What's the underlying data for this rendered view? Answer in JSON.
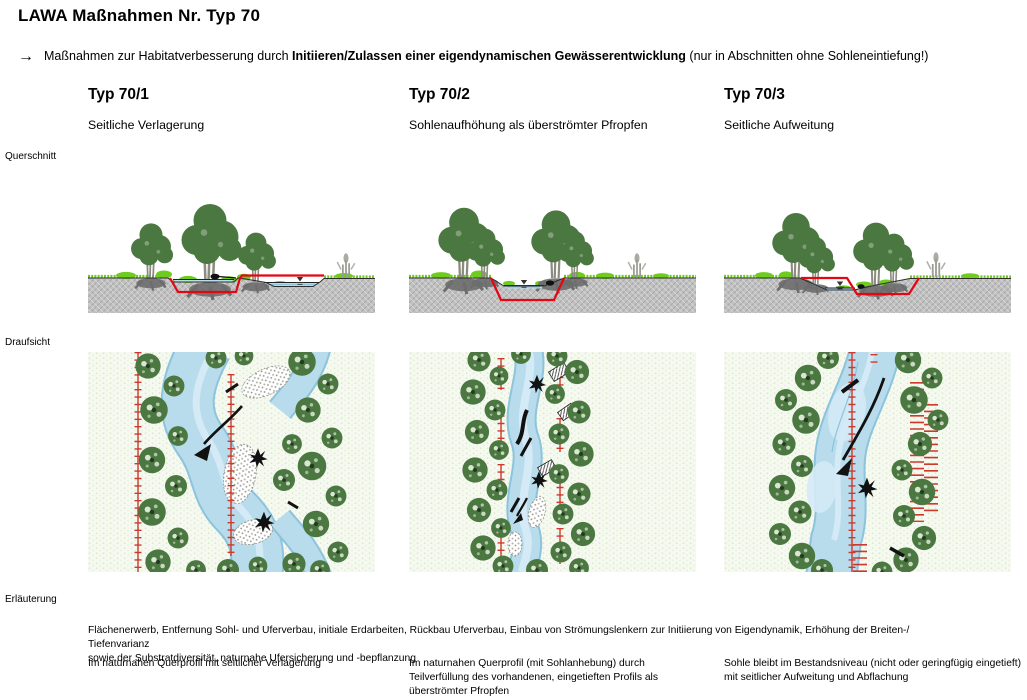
{
  "header": {
    "title": "LAWA Maßnahmen Nr. Typ 70",
    "arrow": "→",
    "intro_prefix": "Maßnahmen zur Habitatverbesserung durch ",
    "intro_bold": "Initiieren/Zulassen einer eigendynamischen Gewässerentwicklung",
    "intro_suffix": " (nur in Abschnitten ohne Sohleneintiefung!)"
  },
  "row_labels": {
    "cross_section": "Querschnitt",
    "top_view": "Draufsicht",
    "explanation": "Erläuterung"
  },
  "columns": [
    {
      "id": "Typ 70/1",
      "title": "Seitliche Verlagerung",
      "note": "Im naturnahen Querprofil mit seitlicher Verlagerung"
    },
    {
      "id": "Typ 70/2",
      "title": "Sohlenaufhöhung als überströmter Pfropfen",
      "note": "Im naturnahen Querprofil (mit Sohlanhebung) durch Teilverfüllung des vorhandenen, eingetieften Profils als überströmter Pfropfen"
    },
    {
      "id": "Typ 70/3",
      "title": "Seitliche Aufweitung",
      "note": "Sohle bleibt im Bestandsniveau (nicht oder geringfügig eingetieft) mit seitlicher Aufweitung und Abflachung"
    }
  ],
  "explanation": {
    "common_line1": "Flächenerwerb, Entfernung Sohl- und Uferverbau, initiale Erdarbeiten, Rückbau Uferverbau, Einbau von Strömungslenkern zur Initiierung von Eigendynamik, Erhöhung der Breiten-/ Tiefenvarianz",
    "common_line2": "sowie der Substratdiversität, naturnahe Ufersicherung und -bepflanzung"
  },
  "colors": {
    "tree": "#4b7741",
    "shrub": "#6fcc1f",
    "water": "#b9dcec",
    "wateredge": "#8cc3dd",
    "ground": "#c1c1c1",
    "red": "#e30613",
    "ladder": "#cc3a2e",
    "meadow": "#f5f9f0",
    "meadowdot": "#d6e8c6"
  }
}
